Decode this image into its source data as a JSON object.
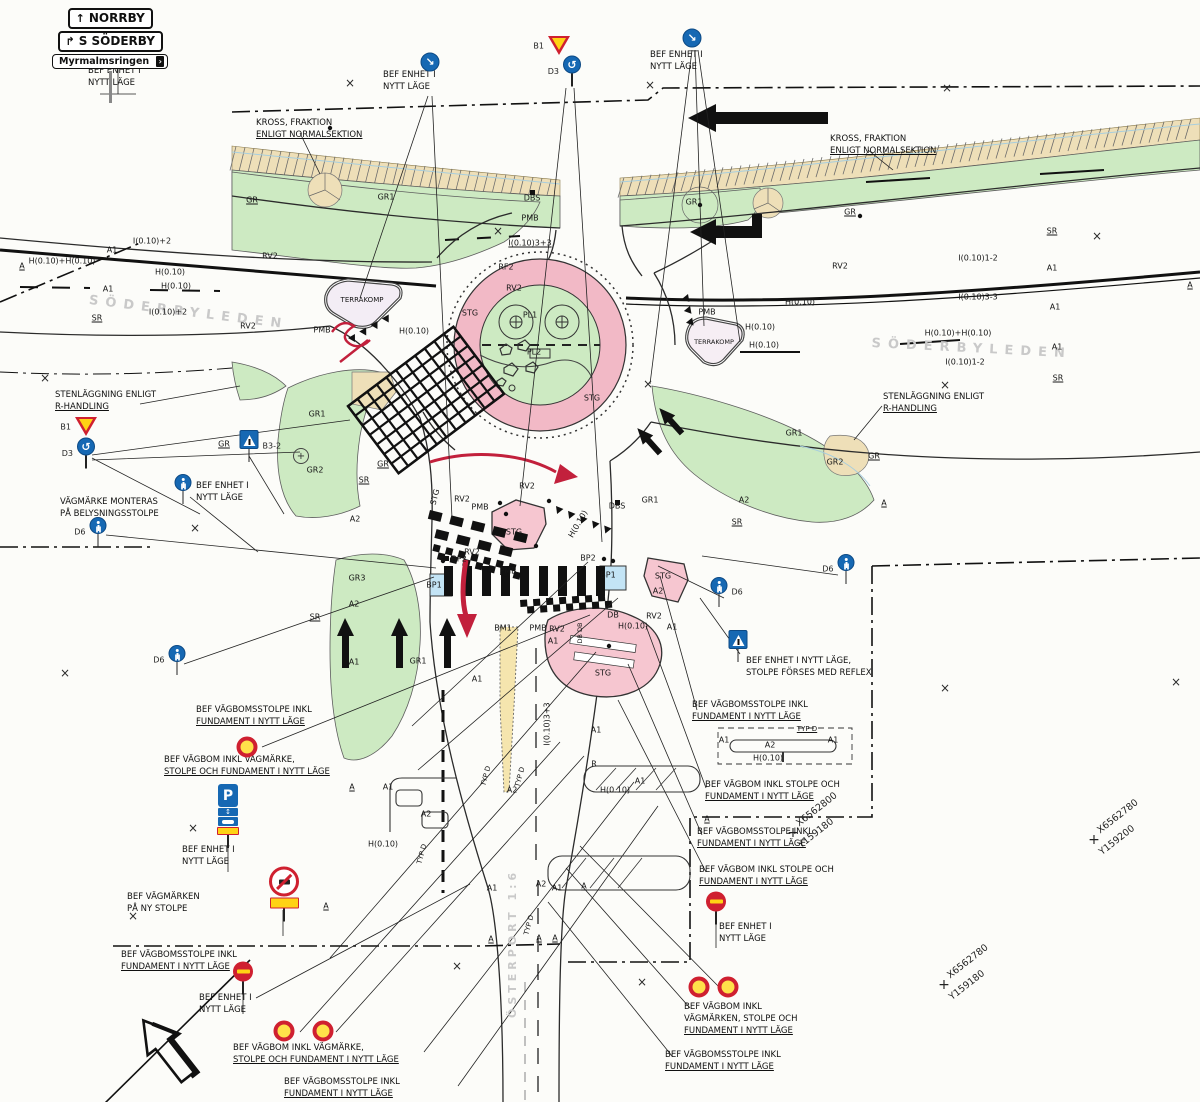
{
  "direction_sign": {
    "x": 52,
    "y": 8,
    "rows": [
      {
        "arrow": "↑",
        "text": "NORRBY"
      },
      {
        "arrow": "↱",
        "text": "S SÖDERBY"
      },
      {
        "arrow": "",
        "text": "Myrmalmsringen",
        "chevron": "›"
      }
    ]
  },
  "street_names": [
    {
      "text": "SÖDERBYLEDEN",
      "x": 90,
      "y": 293,
      "rotation": 7,
      "size": 13,
      "spacing": 7
    },
    {
      "text": "SÖDERBYLEDEN",
      "x": 872,
      "y": 336,
      "rotation": 3,
      "size": 13,
      "spacing": 7
    }
  ],
  "property_label": {
    "text": "ÖSTERPORT 1:6",
    "x": 506,
    "y": 1018,
    "rotation": -90,
    "size": 11,
    "spacing": 4
  },
  "callouts": [
    {
      "x": 88,
      "y": 66,
      "lines": [
        "BEF ENHET I",
        "NYTT LÄGE"
      ]
    },
    {
      "x": 383,
      "y": 70,
      "lines": [
        "BEF ENHET I",
        "NYTT LÄGE"
      ]
    },
    {
      "x": 650,
      "y": 50,
      "lines": [
        "BEF ENHET I",
        "NYTT LÄGE"
      ]
    },
    {
      "x": 256,
      "y": 118,
      "lines": [
        "KROSS, FRAKTION",
        "ENLIGT NORMALSEKTION"
      ],
      "u": 1
    },
    {
      "x": 830,
      "y": 134,
      "lines": [
        "KROSS, FRAKTION",
        "ENLIGT NORMALSEKTION"
      ],
      "u": 1
    },
    {
      "x": 55,
      "y": 390,
      "lines": [
        "STENLÄGGNING ENLIGT",
        "R-HANDLING"
      ],
      "u": 1
    },
    {
      "x": 883,
      "y": 392,
      "lines": [
        "STENLÄGGNING ENLIGT",
        "R-HANDLING"
      ],
      "u": 1
    },
    {
      "x": 196,
      "y": 481,
      "lines": [
        "BEF ENHET I",
        "NYTT LÄGE"
      ]
    },
    {
      "x": 60,
      "y": 497,
      "lines": [
        "VÄGMÄRKE MONTERAS",
        "PÅ BELYSNINGSSTOLPE"
      ]
    },
    {
      "x": 746,
      "y": 656,
      "lines": [
        "BEF ENHET I NYTT LÄGE,",
        "STOLPE FÖRSES MED REFLEX"
      ]
    },
    {
      "x": 196,
      "y": 705,
      "lines": [
        "BEF VÄGBOMSSTOLPE INKL",
        "FUNDAMENT I NYTT LÄGE"
      ],
      "u": 1
    },
    {
      "x": 164,
      "y": 755,
      "lines": [
        "BEF VÄGBOM INKL VÄGMÄRKE,",
        "STOLPE OCH FUNDAMENT I NYTT LÄGE"
      ],
      "u": 1
    },
    {
      "x": 182,
      "y": 845,
      "lines": [
        "BEF ENHET I",
        "NYTT LÄGE"
      ]
    },
    {
      "x": 127,
      "y": 892,
      "lines": [
        "BEF VÄGMÄRKEN",
        "PÅ NY STOLPE"
      ]
    },
    {
      "x": 121,
      "y": 950,
      "lines": [
        "BEF VÄGBOMSSTOLPE INKL",
        "FUNDAMENT I NYTT LÄGE"
      ],
      "u": 1
    },
    {
      "x": 199,
      "y": 993,
      "lines": [
        "BEF ENHET I",
        "NYTT LÄGE"
      ]
    },
    {
      "x": 233,
      "y": 1043,
      "lines": [
        "BEF VÄGBOM INKL VÄGMÄRKE,",
        "STOLPE OCH FUNDAMENT I NYTT LÄGE"
      ],
      "u": 1
    },
    {
      "x": 284,
      "y": 1077,
      "lines": [
        "BEF VÄGBOMSSTOLPE INKL",
        "FUNDAMENT I NYTT LÄGE"
      ],
      "u": 1
    },
    {
      "x": 692,
      "y": 700,
      "lines": [
        "BEF VÄGBOMSSTOLPE INKL",
        "FUNDAMENT I NYTT LÄGE"
      ],
      "u": 1
    },
    {
      "x": 705,
      "y": 780,
      "lines": [
        "BEF VÄGBOM INKL STOLPE OCH",
        "FUNDAMENT I NYTT LÄGE"
      ],
      "u": 1
    },
    {
      "x": 697,
      "y": 827,
      "lines": [
        "BEF VÄGBOMSSTOLPE INKL",
        "FUNDAMENT I NYTT LÄGE"
      ],
      "u": 1
    },
    {
      "x": 699,
      "y": 865,
      "lines": [
        "BEF VÄGBOM INKL STOLPE OCH",
        "FUNDAMENT I NYTT LÄGE"
      ],
      "u": 1
    },
    {
      "x": 719,
      "y": 922,
      "lines": [
        "BEF ENHET I",
        "NYTT LÄGE"
      ]
    },
    {
      "x": 684,
      "y": 1002,
      "lines": [
        "BEF VÄGBOM INKL",
        "VÄGMÄRKEN, STOLPE OCH",
        "FUNDAMENT I NYTT LÄGE"
      ],
      "u": 1
    },
    {
      "x": 665,
      "y": 1050,
      "lines": [
        "BEF VÄGBOMSSTOLPE INKL",
        "FUNDAMENT I NYTT LÄGE"
      ],
      "u": 1
    }
  ],
  "plan_labels": [
    {
      "t": "A",
      "x": 22,
      "y": 266,
      "u": 1
    },
    {
      "t": "H(0.10)+H(0.10)",
      "x": 62,
      "y": 261
    },
    {
      "t": "A1",
      "x": 112,
      "y": 250
    },
    {
      "t": "I(0.10)+2",
      "x": 152,
      "y": 241
    },
    {
      "t": "H(0.10)",
      "x": 170,
      "y": 272
    },
    {
      "t": "H(0.10)",
      "x": 176,
      "y": 286
    },
    {
      "t": "A1",
      "x": 108,
      "y": 289
    },
    {
      "t": "I(0.10)+2",
      "x": 168,
      "y": 312
    },
    {
      "t": "SR",
      "x": 97,
      "y": 318,
      "u": 1
    },
    {
      "t": "RV2",
      "x": 270,
      "y": 256
    },
    {
      "t": "RV2",
      "x": 248,
      "y": 326
    },
    {
      "t": "GR",
      "x": 252,
      "y": 200,
      "u": 1
    },
    {
      "t": "GR1",
      "x": 386,
      "y": 197
    },
    {
      "t": "DBS",
      "x": 532,
      "y": 198
    },
    {
      "t": "PMB",
      "x": 530,
      "y": 218
    },
    {
      "t": "I(0.10)3+3",
      "x": 530,
      "y": 243,
      "u": 1
    },
    {
      "t": "RF2",
      "x": 506,
      "y": 267
    },
    {
      "t": "RV2",
      "x": 514,
      "y": 288
    },
    {
      "t": "STG",
      "x": 470,
      "y": 313
    },
    {
      "t": "PL1",
      "x": 530,
      "y": 315
    },
    {
      "t": "PL2",
      "x": 534,
      "y": 352
    },
    {
      "t": "STG",
      "x": 592,
      "y": 398
    },
    {
      "t": "TERRAKOMP",
      "x": 362,
      "y": 300,
      "s": 7
    },
    {
      "t": "PMB",
      "x": 322,
      "y": 330
    },
    {
      "t": "H(0.10)",
      "x": 414,
      "y": 331
    },
    {
      "t": "GR1",
      "x": 694,
      "y": 202
    },
    {
      "t": "GR",
      "x": 850,
      "y": 212,
      "u": 1
    },
    {
      "t": "SR",
      "x": 1052,
      "y": 231,
      "u": 1
    },
    {
      "t": "I(0.10)1-2",
      "x": 978,
      "y": 258
    },
    {
      "t": "A1",
      "x": 1052,
      "y": 268
    },
    {
      "t": "I(0.10)3-3",
      "x": 978,
      "y": 297
    },
    {
      "t": "A1",
      "x": 1055,
      "y": 307
    },
    {
      "t": "H(0.10)+H(0.10)",
      "x": 958,
      "y": 333
    },
    {
      "t": "A1",
      "x": 1057,
      "y": 347
    },
    {
      "t": "I(0.10)1-2",
      "x": 965,
      "y": 362
    },
    {
      "t": "SR",
      "x": 1058,
      "y": 378,
      "u": 1
    },
    {
      "t": "A",
      "x": 1190,
      "y": 285,
      "u": 1
    },
    {
      "t": "RV2",
      "x": 840,
      "y": 266
    },
    {
      "t": "PMB",
      "x": 707,
      "y": 312
    },
    {
      "t": "H(0.10)",
      "x": 800,
      "y": 302
    },
    {
      "t": "H(0.10)",
      "x": 760,
      "y": 327
    },
    {
      "t": "H(0.10)",
      "x": 764,
      "y": 345
    },
    {
      "t": "TERRAKOMP",
      "x": 714,
      "y": 342,
      "s": 6.5
    },
    {
      "t": "GR1",
      "x": 794,
      "y": 433
    },
    {
      "t": "GR2",
      "x": 835,
      "y": 462
    },
    {
      "t": "GR",
      "x": 874,
      "y": 456,
      "u": 1
    },
    {
      "t": "A",
      "x": 884,
      "y": 503,
      "u": 1
    },
    {
      "t": "GR1",
      "x": 317,
      "y": 414
    },
    {
      "t": "GR2",
      "x": 315,
      "y": 470
    },
    {
      "t": "GR",
      "x": 224,
      "y": 444,
      "u": 1
    },
    {
      "t": "GR",
      "x": 383,
      "y": 464,
      "u": 1
    },
    {
      "t": "SR",
      "x": 364,
      "y": 480,
      "u": 1
    },
    {
      "t": "A2",
      "x": 355,
      "y": 519
    },
    {
      "t": "GR3",
      "x": 357,
      "y": 578
    },
    {
      "t": "A2",
      "x": 354,
      "y": 604
    },
    {
      "t": "SR",
      "x": 315,
      "y": 617,
      "u": 1
    },
    {
      "t": "A1",
      "x": 354,
      "y": 662
    },
    {
      "t": "GR1",
      "x": 418,
      "y": 661
    },
    {
      "t": "A1",
      "x": 477,
      "y": 679
    },
    {
      "t": "STG",
      "x": 435,
      "y": 497,
      "r": -75
    },
    {
      "t": "RV2",
      "x": 462,
      "y": 499
    },
    {
      "t": "PMB",
      "x": 480,
      "y": 507
    },
    {
      "t": "RV2",
      "x": 527,
      "y": 486
    },
    {
      "t": "STG",
      "x": 514,
      "y": 532
    },
    {
      "t": "H(0.10)",
      "x": 578,
      "y": 524,
      "r": -60
    },
    {
      "t": "DBS",
      "x": 617,
      "y": 506
    },
    {
      "t": "GR1",
      "x": 650,
      "y": 500
    },
    {
      "t": "A2",
      "x": 744,
      "y": 500
    },
    {
      "t": "SR",
      "x": 737,
      "y": 522,
      "u": 1
    },
    {
      "t": "BP2",
      "x": 459,
      "y": 559
    },
    {
      "t": "RV2",
      "x": 472,
      "y": 552
    },
    {
      "t": "BP1",
      "x": 434,
      "y": 585
    },
    {
      "t": "PMB",
      "x": 508,
      "y": 571
    },
    {
      "t": "BP2",
      "x": 588,
      "y": 558
    },
    {
      "t": "BP1",
      "x": 608,
      "y": 575
    },
    {
      "t": "STG",
      "x": 663,
      "y": 576
    },
    {
      "t": "A2",
      "x": 658,
      "y": 591
    },
    {
      "t": "DB",
      "x": 613,
      "y": 615
    },
    {
      "t": "H(0.10)",
      "x": 633,
      "y": 626
    },
    {
      "t": "RV2",
      "x": 654,
      "y": 616
    },
    {
      "t": "A1",
      "x": 672,
      "y": 627
    },
    {
      "t": "BM1",
      "x": 503,
      "y": 628
    },
    {
      "t": "PMB",
      "x": 538,
      "y": 628
    },
    {
      "t": "RV2",
      "x": 557,
      "y": 629
    },
    {
      "t": "A1",
      "x": 553,
      "y": 641
    },
    {
      "t": "DB DB",
      "x": 580,
      "y": 633,
      "r": -90,
      "s": 6.5
    },
    {
      "t": "STG",
      "x": 603,
      "y": 673
    },
    {
      "t": "I(0.10)3+3",
      "x": 547,
      "y": 724,
      "r": -90
    },
    {
      "t": "A1",
      "x": 596,
      "y": 730
    },
    {
      "t": "R",
      "x": 594,
      "y": 764
    },
    {
      "t": "TYP D",
      "x": 520,
      "y": 777,
      "r": -75,
      "s": 7
    },
    {
      "t": "TYP D",
      "x": 486,
      "y": 776,
      "r": -75,
      "s": 7
    },
    {
      "t": "A2",
      "x": 512,
      "y": 790
    },
    {
      "t": "H(0.10)",
      "x": 615,
      "y": 790
    },
    {
      "t": "A1",
      "x": 640,
      "y": 781
    },
    {
      "t": "A",
      "x": 352,
      "y": 787,
      "u": 1
    },
    {
      "t": "A1",
      "x": 388,
      "y": 787
    },
    {
      "t": "A2",
      "x": 426,
      "y": 814
    },
    {
      "t": "H(0.10)",
      "x": 383,
      "y": 844
    },
    {
      "t": "TYP D",
      "x": 422,
      "y": 854,
      "r": -75,
      "s": 7
    },
    {
      "t": "A1",
      "x": 492,
      "y": 888
    },
    {
      "t": "A2",
      "x": 541,
      "y": 884
    },
    {
      "t": "A1",
      "x": 557,
      "y": 888
    },
    {
      "t": "A",
      "x": 584,
      "y": 886,
      "u": 1
    },
    {
      "t": "A",
      "x": 491,
      "y": 939,
      "u": 1
    },
    {
      "t": "A",
      "x": 539,
      "y": 938,
      "u": 1
    },
    {
      "t": "A",
      "x": 555,
      "y": 938,
      "u": 1
    },
    {
      "t": "TYP D",
      "x": 529,
      "y": 925,
      "r": -75,
      "s": 7
    },
    {
      "t": "TYP D",
      "x": 807,
      "y": 729,
      "u": 1,
      "s": 7
    },
    {
      "t": "A1",
      "x": 724,
      "y": 740
    },
    {
      "t": "A1",
      "x": 833,
      "y": 740
    },
    {
      "t": "A2",
      "x": 770,
      "y": 745
    },
    {
      "t": "H(0.10)",
      "x": 768,
      "y": 758
    },
    {
      "t": "A",
      "x": 707,
      "y": 819,
      "u": 1
    },
    {
      "t": "A",
      "x": 326,
      "y": 906,
      "u": 1
    }
  ],
  "signs": [
    {
      "type": "keep-right",
      "x": 430,
      "y": 62
    },
    {
      "type": "keep-right",
      "x": 692,
      "y": 38
    },
    {
      "type": "yield",
      "x": 559,
      "y": 46,
      "label": "B1",
      "side": "left"
    },
    {
      "type": "roundabout",
      "x": 572,
      "y": 71,
      "label": "D3",
      "side": "left"
    },
    {
      "type": "yield",
      "x": 86,
      "y": 427,
      "label": "B1",
      "side": "left"
    },
    {
      "type": "roundabout",
      "x": 86,
      "y": 453,
      "label": "D3",
      "side": "left"
    },
    {
      "type": "ped-crossing",
      "x": 249,
      "y": 446,
      "label": "B3-2",
      "side": "right"
    },
    {
      "type": "d6",
      "x": 183,
      "y": 489
    },
    {
      "type": "d6",
      "x": 98,
      "y": 532,
      "label": "D6",
      "side": "left"
    },
    {
      "type": "d6",
      "x": 177,
      "y": 660,
      "label": "D6",
      "side": "left"
    },
    {
      "type": "d6",
      "x": 719,
      "y": 592,
      "label": "D6",
      "side": "right"
    },
    {
      "type": "d6",
      "x": 846,
      "y": 569,
      "label": "D6",
      "side": "left"
    },
    {
      "type": "ped-crossing",
      "x": 738,
      "y": 646
    },
    {
      "type": "no-entry",
      "x": 243,
      "y": 978
    },
    {
      "type": "no-entry",
      "x": 716,
      "y": 908
    },
    {
      "type": "truck-ban",
      "x": 284,
      "y": 894
    },
    {
      "type": "p-sign",
      "x": 228,
      "y": 816,
      "label": "P"
    },
    {
      "type": "vagbom",
      "x": 247,
      "y": 747
    },
    {
      "type": "vagbom",
      "x": 284,
      "y": 1031
    },
    {
      "type": "vagbom",
      "x": 323,
      "y": 1031
    },
    {
      "type": "vagbom",
      "x": 699,
      "y": 987
    },
    {
      "type": "vagbom",
      "x": 728,
      "y": 987
    },
    {
      "type": "plus-circle",
      "x": 301,
      "y": 456
    }
  ],
  "coord_crosses": [
    {
      "x": 793,
      "y": 833,
      "line1": "X6562800",
      "line2": "Y159180"
    },
    {
      "x": 1094,
      "y": 840,
      "line1": "X6562780",
      "line2": "Y159200"
    },
    {
      "x": 944,
      "y": 985,
      "line1": "X6562780",
      "line2": "Y159180"
    }
  ],
  "x_marks": [
    [
      350,
      83
    ],
    [
      650,
      85
    ],
    [
      947,
      88
    ],
    [
      1097,
      236
    ],
    [
      498,
      231
    ],
    [
      648,
      384
    ],
    [
      945,
      385
    ],
    [
      45,
      378
    ],
    [
      195,
      528
    ],
    [
      65,
      673
    ],
    [
      945,
      688
    ],
    [
      1176,
      682
    ],
    [
      193,
      828
    ],
    [
      133,
      916
    ],
    [
      642,
      982
    ],
    [
      457,
      966
    ]
  ],
  "colors": {
    "green": "#cdeac2",
    "pink_ring": "#f2b9c6",
    "pink_island": "#f6c6d0",
    "tan": "#eedfb8",
    "yellow_island": "#f5e5ae",
    "blue_marking": "#c3e4f5",
    "red_annotation": "#c2203c",
    "sign_blue": "#1668b3",
    "sign_yellow": "#fed314",
    "sign_red": "#cf2030"
  }
}
